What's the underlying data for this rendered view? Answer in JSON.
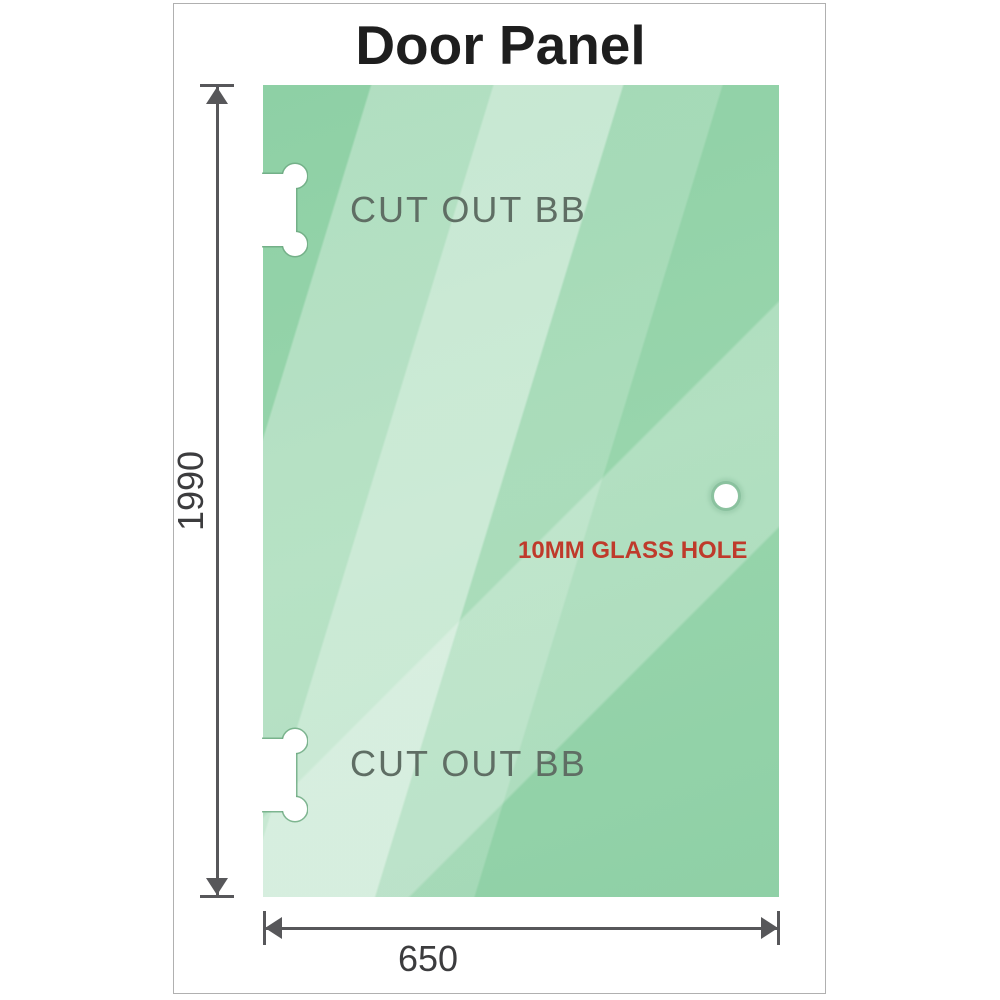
{
  "title": "Door Panel",
  "panel": {
    "cutouts": [
      {
        "label": "CUT OUT BB"
      },
      {
        "label": "CUT OUT BB"
      }
    ],
    "hole": {
      "label": "10MM GLASS HOLE"
    }
  },
  "dimensions": {
    "height": "1990",
    "width": "650"
  },
  "colors": {
    "glass_base": "#8ed0a5",
    "glass_highlight": "#cfeeda",
    "title_text": "#1e1e1e",
    "cutout_label_text": "#5f6e64",
    "hole_label_text": "#bf3a2b",
    "dimension_line": "#57575a",
    "frame_border": "#b0b0b0"
  }
}
